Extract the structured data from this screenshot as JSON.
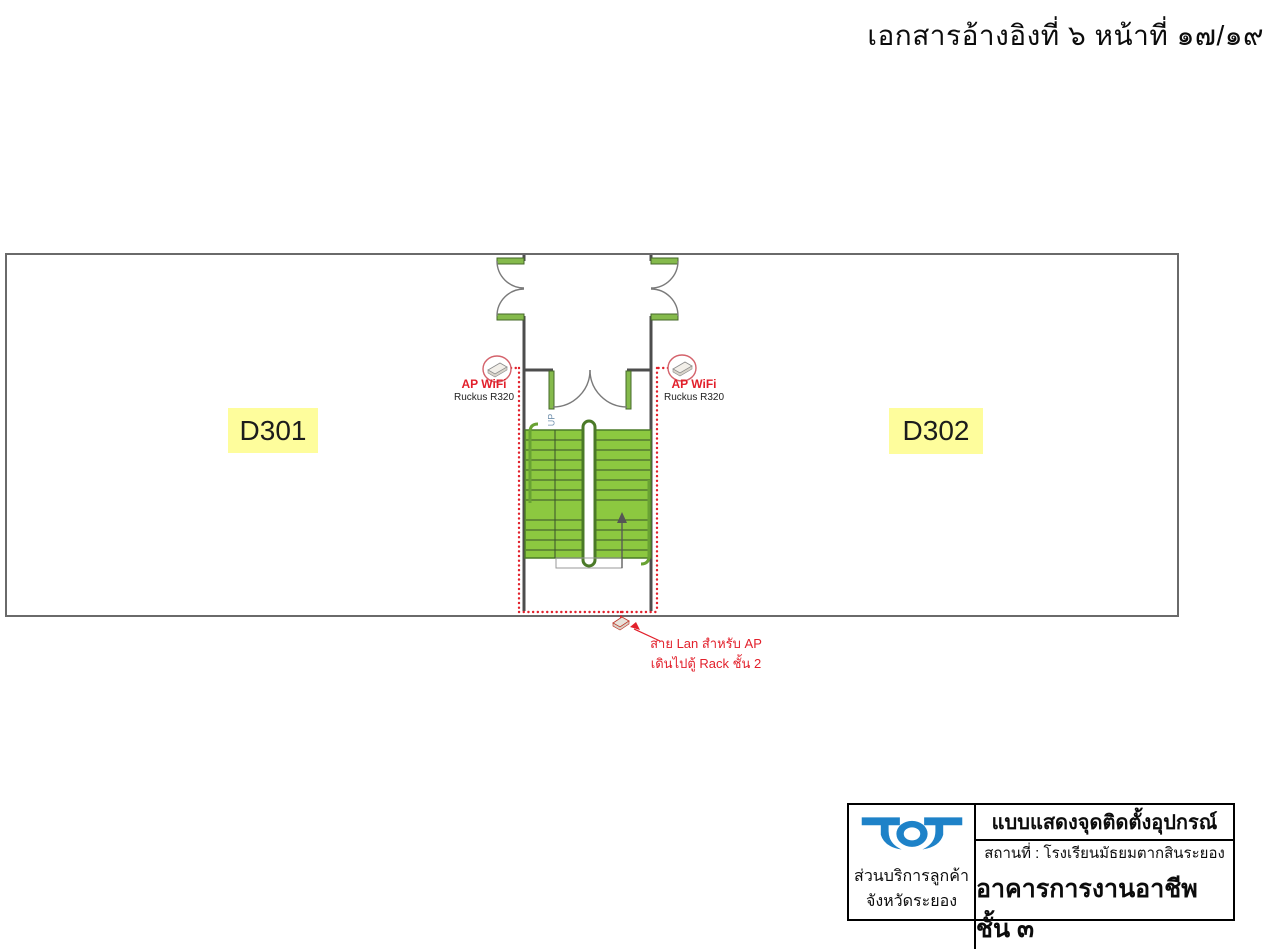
{
  "header": {
    "reference": "เอกสารอ้างอิงที่ ๖ หน้าที่ ๑๗/๑๙"
  },
  "floorplan": {
    "rooms": [
      {
        "label": "D301"
      },
      {
        "label": "D302"
      }
    ],
    "stairs": {
      "direction_label": "UP"
    },
    "access_points": [
      {
        "label": "AP WiFi",
        "model": "Ruckus R320"
      },
      {
        "label": "AP WiFi",
        "model": "Ruckus R320"
      }
    ],
    "cable_note": {
      "line1": "สาย Lan สำหรับ AP",
      "line2": "เดินไปตู้ Rack ชั้น 2"
    },
    "colors": {
      "stair_green": "#8CC840",
      "door_sill_green": "#85BA4C",
      "room_label_yellow": "#FEFD9C",
      "cable_red": "#E2202B",
      "wall_gray": "#4D4D4D"
    }
  },
  "title_block": {
    "logo_text": "TOT",
    "logo_color": "#1E82C8",
    "department_line1": "ส่วนบริการลูกค้า",
    "department_line2": "จังหวัดระยอง",
    "drawing_title": "แบบแสดงจุดติดตั้งอุปกรณ์",
    "location": "สถานที่ : โรงเรียนมัธยมตากสินระยอง",
    "building": "อาคารการงานอาชีพ ชั้น ๓"
  }
}
